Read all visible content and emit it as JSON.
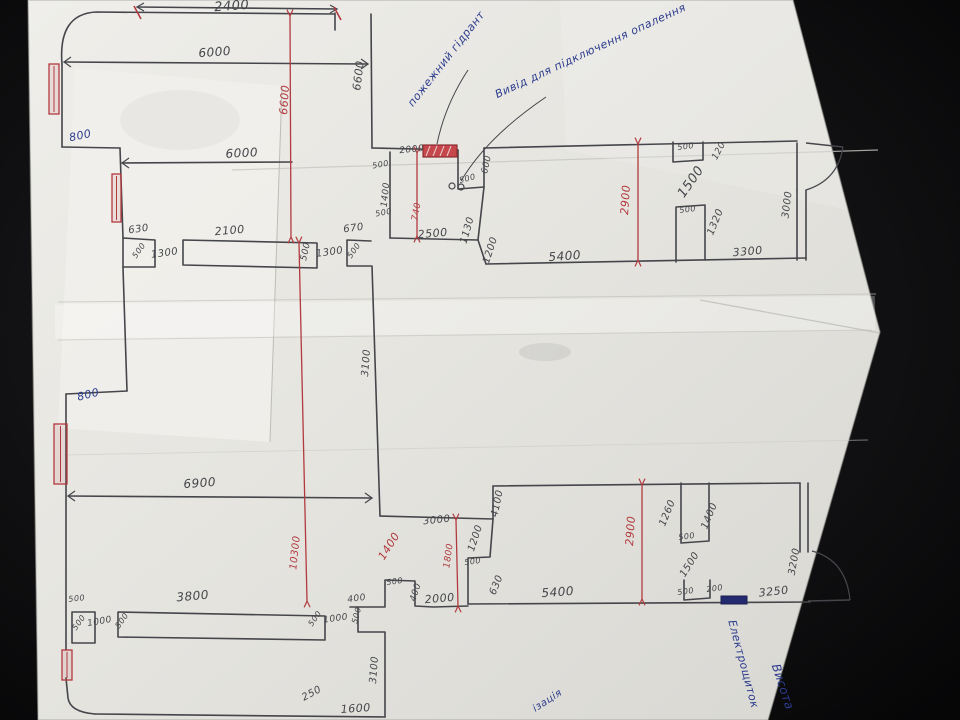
{
  "scene": {
    "description": "Photograph of a hand-drawn floor-plan sketch with dimensions, on creased white paper over a dark surface",
    "colors": {
      "background": "#121214",
      "paper": "#e8e7e2",
      "pencil": "#45464b",
      "red": "#b23a3f",
      "blue": "#2c3c8e"
    }
  },
  "plan": {
    "labels": [
      {
        "text": "2400",
        "x": 232,
        "y": 10,
        "r": -4,
        "c": "pencil",
        "s": 13
      },
      {
        "text": "6000",
        "x": 215,
        "y": 56,
        "r": -4,
        "c": "pencil",
        "s": 12
      },
      {
        "text": "6600",
        "x": 288,
        "y": 100,
        "r": -86,
        "c": "red",
        "s": 11
      },
      {
        "text": "6600",
        "x": 362,
        "y": 76,
        "r": -83,
        "c": "pencil",
        "s": 11
      },
      {
        "text": "пожежний гідрант",
        "x": 449,
        "y": 61,
        "r": -52,
        "c": "blue",
        "s": 11
      },
      {
        "text": "Вивід для підключення опалення",
        "x": 592,
        "y": 54,
        "r": -25,
        "c": "blue",
        "s": 11
      },
      {
        "text": "800",
        "x": 81,
        "y": 139,
        "r": -12,
        "c": "blue",
        "s": 11
      },
      {
        "text": "6000",
        "x": 242,
        "y": 157,
        "r": -3,
        "c": "pencil",
        "s": 12
      },
      {
        "text": "500",
        "x": 381,
        "y": 167,
        "r": -10,
        "c": "pencil",
        "s": 8
      },
      {
        "text": "2000",
        "x": 412,
        "y": 152,
        "r": -6,
        "c": "pencil",
        "s": 9
      },
      {
        "text": "500",
        "x": 468,
        "y": 181,
        "r": -15,
        "c": "pencil",
        "s": 8
      },
      {
        "text": "600",
        "x": 489,
        "y": 165,
        "r": -78,
        "c": "pencil",
        "s": 9
      },
      {
        "text": "1400",
        "x": 388,
        "y": 195,
        "r": -84,
        "c": "pencil",
        "s": 9
      },
      {
        "text": "740",
        "x": 419,
        "y": 212,
        "r": -80,
        "c": "red",
        "s": 9
      },
      {
        "text": "500",
        "x": 384,
        "y": 215,
        "r": -10,
        "c": "pencil",
        "s": 8
      },
      {
        "text": "1130",
        "x": 470,
        "y": 231,
        "r": -74,
        "c": "pencil",
        "s": 10
      },
      {
        "text": "670",
        "x": 354,
        "y": 231,
        "r": -8,
        "c": "pencil",
        "s": 10
      },
      {
        "text": "500",
        "x": 356,
        "y": 252,
        "r": -55,
        "c": "pencil",
        "s": 8
      },
      {
        "text": "2500",
        "x": 433,
        "y": 237,
        "r": -5,
        "c": "pencil",
        "s": 11
      },
      {
        "text": "1300",
        "x": 330,
        "y": 255,
        "r": -8,
        "c": "pencil",
        "s": 10
      },
      {
        "text": "630",
        "x": 139,
        "y": 232,
        "r": -8,
        "c": "pencil",
        "s": 10
      },
      {
        "text": "500",
        "x": 141,
        "y": 252,
        "r": -55,
        "c": "pencil",
        "s": 8
      },
      {
        "text": "1300",
        "x": 165,
        "y": 256,
        "r": -8,
        "c": "pencil",
        "s": 10
      },
      {
        "text": "2100",
        "x": 230,
        "y": 234,
        "r": -5,
        "c": "pencil",
        "s": 11
      },
      {
        "text": "500",
        "x": 308,
        "y": 252,
        "r": -78,
        "c": "pencil",
        "s": 9
      },
      {
        "text": "500",
        "x": 686,
        "y": 149,
        "r": -8,
        "c": "pencil",
        "s": 8
      },
      {
        "text": "120",
        "x": 721,
        "y": 152,
        "r": -62,
        "c": "pencil",
        "s": 9
      },
      {
        "text": "1500",
        "x": 694,
        "y": 184,
        "r": -55,
        "c": "pencil",
        "s": 13
      },
      {
        "text": "500",
        "x": 688,
        "y": 212,
        "r": -8,
        "c": "pencil",
        "s": 8
      },
      {
        "text": "1320",
        "x": 718,
        "y": 223,
        "r": -68,
        "c": "pencil",
        "s": 10
      },
      {
        "text": "2900",
        "x": 629,
        "y": 200,
        "r": -86,
        "c": "red",
        "s": 11
      },
      {
        "text": "3000",
        "x": 790,
        "y": 205,
        "r": -83,
        "c": "pencil",
        "s": 10
      },
      {
        "text": "3300",
        "x": 748,
        "y": 255,
        "r": -5,
        "c": "pencil",
        "s": 11
      },
      {
        "text": "1200",
        "x": 493,
        "y": 251,
        "r": -72,
        "c": "pencil",
        "s": 10
      },
      {
        "text": "5400",
        "x": 565,
        "y": 260,
        "r": -4,
        "c": "pencil",
        "s": 12
      },
      {
        "text": "3100",
        "x": 369,
        "y": 363,
        "r": -86,
        "c": "pencil",
        "s": 10
      },
      {
        "text": "800",
        "x": 89,
        "y": 398,
        "r": -14,
        "c": "blue",
        "s": 11
      },
      {
        "text": "6900",
        "x": 200,
        "y": 487,
        "r": -4,
        "c": "pencil",
        "s": 12
      },
      {
        "text": "10300",
        "x": 298,
        "y": 553,
        "r": -84,
        "c": "red",
        "s": 10
      },
      {
        "text": "3000",
        "x": 437,
        "y": 523,
        "r": -6,
        "c": "pencil",
        "s": 10
      },
      {
        "text": "1400",
        "x": 392,
        "y": 548,
        "r": -58,
        "c": "red",
        "s": 11
      },
      {
        "text": "4100",
        "x": 500,
        "y": 504,
        "r": -78,
        "c": "pencil",
        "s": 10
      },
      {
        "text": "1800",
        "x": 451,
        "y": 556,
        "r": -82,
        "c": "red",
        "s": 9
      },
      {
        "text": "1200",
        "x": 478,
        "y": 539,
        "r": -72,
        "c": "pencil",
        "s": 10
      },
      {
        "text": "500",
        "x": 473,
        "y": 564,
        "r": -8,
        "c": "pencil",
        "s": 8
      },
      {
        "text": "630",
        "x": 499,
        "y": 586,
        "r": -68,
        "c": "pencil",
        "s": 10
      },
      {
        "text": "500",
        "x": 395,
        "y": 584,
        "r": -8,
        "c": "pencil",
        "s": 8
      },
      {
        "text": "400",
        "x": 418,
        "y": 593,
        "r": -72,
        "c": "pencil",
        "s": 9
      },
      {
        "text": "2000",
        "x": 440,
        "y": 602,
        "r": -5,
        "c": "pencil",
        "s": 11
      },
      {
        "text": "400",
        "x": 357,
        "y": 601,
        "r": -8,
        "c": "pencil",
        "s": 9
      },
      {
        "text": "500",
        "x": 359,
        "y": 616,
        "r": -75,
        "c": "pencil",
        "s": 8
      },
      {
        "text": "5400",
        "x": 558,
        "y": 596,
        "r": -4,
        "c": "pencil",
        "s": 12
      },
      {
        "text": "1260",
        "x": 670,
        "y": 514,
        "r": -68,
        "c": "pencil",
        "s": 10
      },
      {
        "text": "1400",
        "x": 712,
        "y": 517,
        "r": -68,
        "c": "pencil",
        "s": 10
      },
      {
        "text": "500",
        "x": 687,
        "y": 539,
        "r": -8,
        "c": "pencil",
        "s": 8
      },
      {
        "text": "1500",
        "x": 692,
        "y": 566,
        "r": -58,
        "c": "pencil",
        "s": 10
      },
      {
        "text": "500",
        "x": 686,
        "y": 594,
        "r": -8,
        "c": "pencil",
        "s": 8
      },
      {
        "text": "200",
        "x": 715,
        "y": 591,
        "r": -8,
        "c": "pencil",
        "s": 8
      },
      {
        "text": "3250",
        "x": 774,
        "y": 595,
        "r": -6,
        "c": "pencil",
        "s": 11
      },
      {
        "text": "3200",
        "x": 797,
        "y": 562,
        "r": -80,
        "c": "pencil",
        "s": 10
      },
      {
        "text": "2900",
        "x": 634,
        "y": 531,
        "r": -86,
        "c": "red",
        "s": 11
      },
      {
        "text": "Електрощиток",
        "x": 740,
        "y": 665,
        "r": 75,
        "c": "blue",
        "s": 11
      },
      {
        "text": "Висота",
        "x": 779,
        "y": 688,
        "r": 72,
        "c": "blue",
        "s": 12
      },
      {
        "text": "ізація",
        "x": 549,
        "y": 703,
        "r": -33,
        "c": "blue",
        "s": 10
      },
      {
        "text": "250",
        "x": 313,
        "y": 696,
        "r": -28,
        "c": "pencil",
        "s": 10
      },
      {
        "text": "1600",
        "x": 356,
        "y": 712,
        "r": -4,
        "c": "pencil",
        "s": 11
      },
      {
        "text": "3100",
        "x": 377,
        "y": 670,
        "r": -86,
        "c": "pencil",
        "s": 10
      },
      {
        "text": "3800",
        "x": 193,
        "y": 600,
        "r": -5,
        "c": "pencil",
        "s": 12
      },
      {
        "text": "500",
        "x": 77,
        "y": 601,
        "r": -6,
        "c": "pencil",
        "s": 8
      },
      {
        "text": "500",
        "x": 81,
        "y": 624,
        "r": -55,
        "c": "pencil",
        "s": 8
      },
      {
        "text": "1000",
        "x": 100,
        "y": 624,
        "r": -10,
        "c": "pencil",
        "s": 9
      },
      {
        "text": "500",
        "x": 124,
        "y": 622,
        "r": -55,
        "c": "pencil",
        "s": 8
      },
      {
        "text": "500",
        "x": 317,
        "y": 620,
        "r": -55,
        "c": "pencil",
        "s": 8
      },
      {
        "text": "1000",
        "x": 336,
        "y": 621,
        "r": -8,
        "c": "pencil",
        "s": 9
      }
    ],
    "walls": [
      "M62,64 Q58,14 96,12 L334,14",
      "M335,13 L335,30",
      "M371,14 L372,148",
      "M372,148 L458,150",
      "M458,150 L458,189 L484,187 L484,148",
      "M484,148 L797,141",
      "M797,143 L797,190",
      "M797,190 L797,260",
      "M806,190 L806,260",
      "M484,187 L478,240",
      "M390,152 L390,238",
      "M390,238 L478,240",
      "M478,240 L486,264",
      "M486,264 L806,258",
      "M673,142 L673,162 L703,160 L703,142",
      "M676,262 L676,207 L705,205 L705,260",
      "M62,64 L62,147",
      "M62,147 L120,148",
      "M120,148 L123,238",
      "M123,238 L123,268 L127,391",
      "M127,391 L66,394",
      "M66,394 L66,650",
      "M66,678 L68,698 Q70,712 95,714",
      "M95,714 L385,717",
      "M123,238 L155,240 L155,267 L123,267",
      "M183,240 L317,243 L317,268 L183,265 Z",
      "M347,240 L371,241 M347,240 L347,266 L371,266",
      "M372,266 L380,516",
      "M380,516 L493,519",
      "M493,486 L493,519",
      "M493,486 L800,483",
      "M800,483 L800,552",
      "M808,483 L808,552",
      "M493,519 L490,557 L468,558 L468,604",
      "M468,604 L810,602",
      "M681,483 L681,543 L709,541 L709,483",
      "M684,580 L684,600 L710,598 L710,580",
      "M72,612 L95,612 L95,643 L72,643 Z",
      "M118,612 L325,616 L325,640 L118,637 Z",
      "M350,607 L385,607 L385,580 L415,581 L415,606 L433,607 L468,606",
      "M358,607 L358,632 L385,632 L385,717",
      "M137,7 L337,9",
      "M64,62 L368,64",
      "M122,163 L292,162",
      "M68,496 L372,498"
    ],
    "pencil_ticks": [
      [
        64,
        62,
        71,
        57
      ],
      [
        64,
        62,
        71,
        67
      ],
      [
        368,
        64,
        361,
        59
      ],
      [
        368,
        64,
        361,
        69
      ],
      [
        122,
        163,
        129,
        158
      ],
      [
        122,
        163,
        129,
        168
      ],
      [
        68,
        496,
        75,
        491
      ],
      [
        68,
        496,
        75,
        501
      ],
      [
        372,
        498,
        365,
        493
      ],
      [
        372,
        498,
        365,
        503
      ],
      [
        137,
        7,
        144,
        3
      ],
      [
        137,
        7,
        144,
        11
      ],
      [
        337,
        9,
        330,
        5
      ],
      [
        337,
        9,
        330,
        13
      ]
    ],
    "red_lines": [
      {
        "x1": 290,
        "y1": 16,
        "x2": 291,
        "y2": 237
      },
      {
        "x1": 299,
        "y1": 243,
        "x2": 307,
        "y2": 601
      },
      {
        "x1": 638,
        "y1": 144,
        "x2": 638,
        "y2": 260
      },
      {
        "x1": 642,
        "y1": 485,
        "x2": 642,
        "y2": 599
      },
      {
        "x1": 456,
        "y1": 520,
        "x2": 458,
        "y2": 606
      },
      {
        "x1": 417,
        "y1": 153,
        "x2": 417,
        "y2": 236
      }
    ],
    "red_ticks": [
      [
        134,
        6,
        141,
        19
      ],
      [
        334,
        7,
        341,
        20
      ]
    ],
    "windows": [
      {
        "x": 49,
        "y": 64,
        "w": 10,
        "h": 50
      },
      {
        "x": 112,
        "y": 174,
        "w": 9,
        "h": 48
      },
      {
        "x": 54,
        "y": 424,
        "w": 13,
        "h": 60
      },
      {
        "x": 62,
        "y": 650,
        "w": 10,
        "h": 30
      }
    ],
    "fixtures": {
      "fire_hydrant_box": {
        "x": 423,
        "y": 145,
        "w": 34,
        "h": 12,
        "label": "пожежний гідрант"
      },
      "electrical_panel_box": {
        "x": 721,
        "y": 596,
        "w": 26,
        "h": 8,
        "label": "Електрощиток"
      }
    },
    "doors": [
      {
        "leaf": "M806,143 L843,147",
        "arc": "M843,147 Q838,180 806,190"
      },
      {
        "leaf": "M808,601 L850,600",
        "arc": "M850,600 Q846,560 812,551"
      }
    ],
    "leaders": [
      "M468,70 Q445,105 437,144",
      "M546,97 Q487,137 461,181"
    ],
    "pipe_circles": [
      {
        "cx": 452,
        "cy": 186,
        "r": 3
      },
      {
        "cx": 461,
        "cy": 187,
        "r": 3
      }
    ]
  }
}
